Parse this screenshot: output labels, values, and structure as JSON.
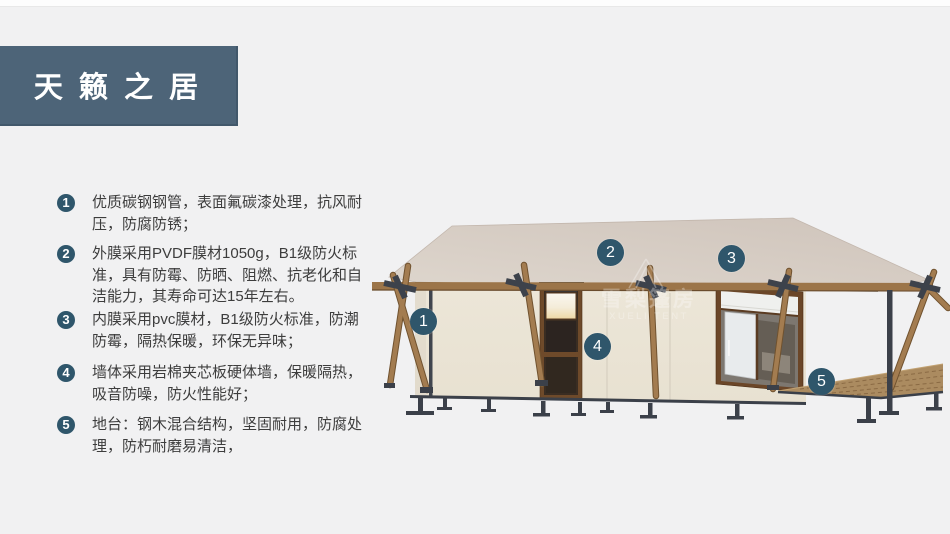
{
  "slide": {
    "title": "天 籁 之 居"
  },
  "features": [
    {
      "num": "1",
      "text": "优质碳钢钢管，表面氟碳漆处理，抗风耐压，防腐防锈；"
    },
    {
      "num": "2",
      "text": "外膜采用PVDF膜材1050g，B1级防火标准，具有防霉、防晒、阻燃、抗老化和自洁能力，其寿命可达15年左右。"
    },
    {
      "num": "3",
      "text": "内膜采用pvc膜材，B1级防火标准，防潮防霉，隔热保暖，环保无异味；"
    },
    {
      "num": "4",
      "text": "墙体采用岩棉夹芯板硬体墙，保暖隔热，吸音防噪，防火性能好；"
    },
    {
      "num": "5",
      "text": "地台：钢木混合结构，坚固耐用，防腐处理，防朽耐磨易清洁，"
    }
  ],
  "diagram": {
    "badges": [
      {
        "num": "1"
      },
      {
        "num": "2"
      },
      {
        "num": "3"
      },
      {
        "num": "4"
      },
      {
        "num": "5"
      }
    ],
    "watermark": {
      "cn": "雪梨篷房",
      "en": "XUELI TENT"
    }
  },
  "colors": {
    "accent": "#2F566B",
    "title_bg": "#4D6478",
    "page_bg": "#F1F1F2",
    "roof": "#D5CBC2",
    "wall": "#EBE5D7",
    "wood": "#9C7549",
    "steel": "#3B4049",
    "deck": "#AB8B60",
    "body_text": "#3D3D3D"
  }
}
